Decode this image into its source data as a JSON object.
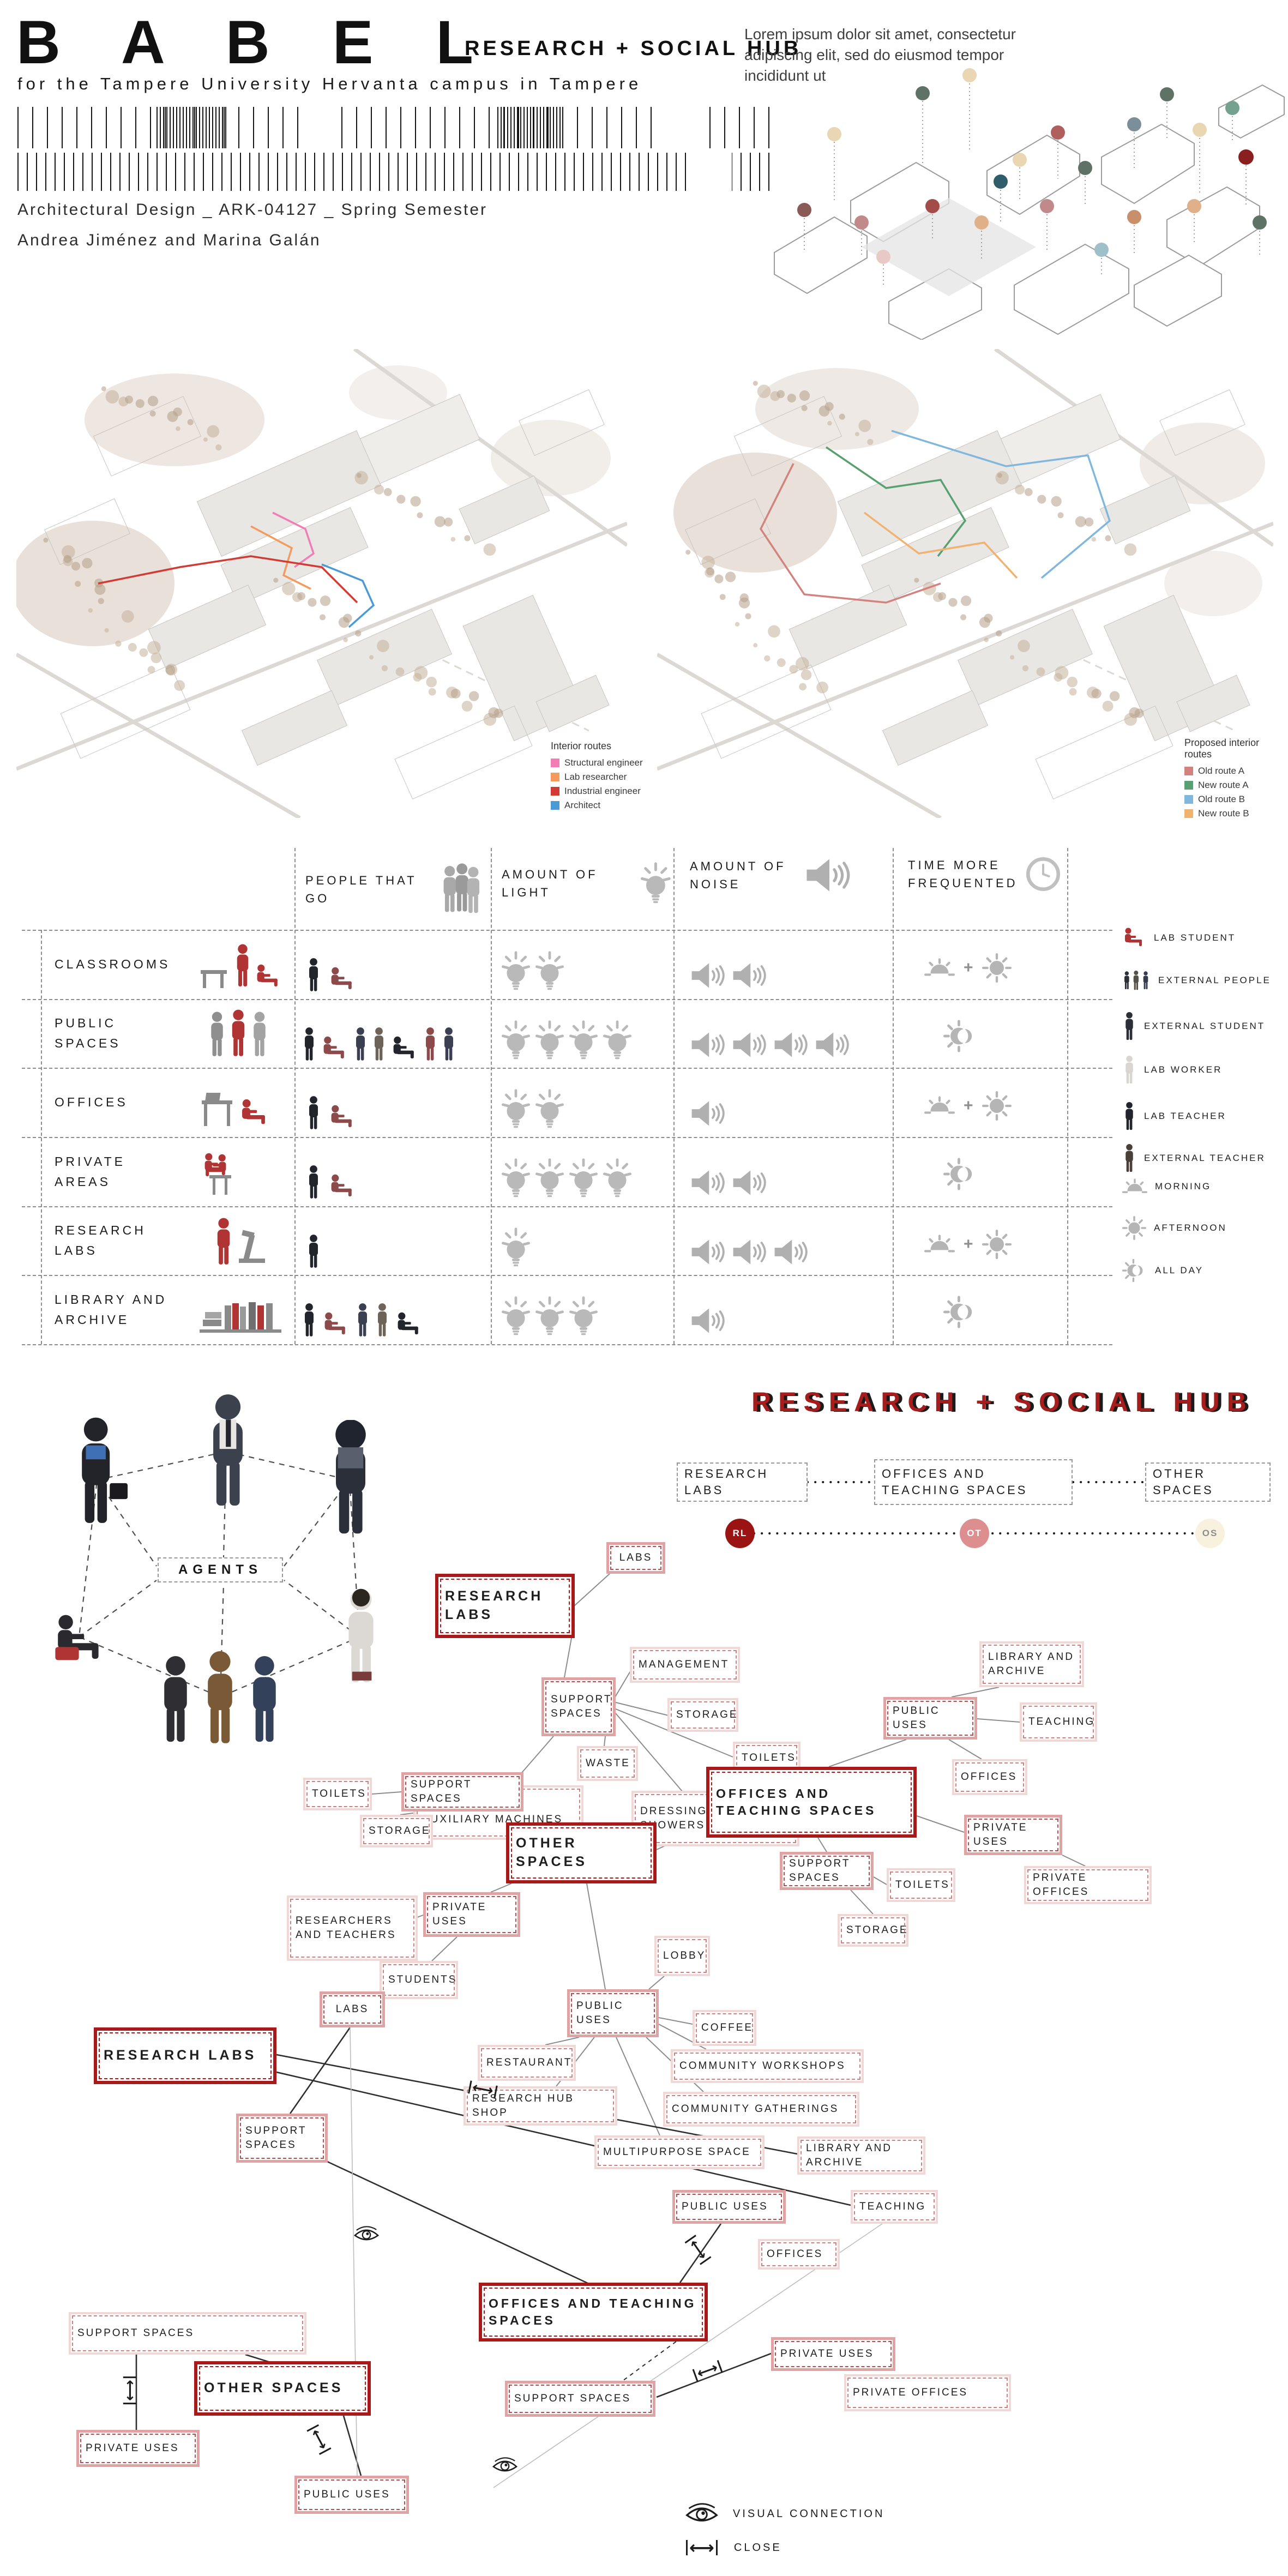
{
  "header": {
    "title": "B A B E L",
    "subtitle": "RESEARCH + SOCIAL HUB",
    "tagline": "for the Tampere University Hervanta campus in Tampere",
    "course": "Architectural Design _ ARK-04127 _ Spring Semester",
    "authors": "Andrea Jiménez and Marina Galán",
    "intro_text": "Lorem ipsum dolor sit amet, consectetur adipiscing elit, sed do eiusmod tempor incididunt ut"
  },
  "maps": {
    "existing": {
      "legend_title": "Interior routes",
      "legend": [
        {
          "label": "Structural engineer",
          "color": "#f27cb4"
        },
        {
          "label": "Lab researcher",
          "color": "#f59a5e"
        },
        {
          "label": "Industrial engineer",
          "color": "#d23b33"
        },
        {
          "label": "Architect",
          "color": "#4a9bd5"
        }
      ]
    },
    "proposed": {
      "legend_title": "Proposed interior routes",
      "legend": [
        {
          "label": "Old route A",
          "color": "#d4827e"
        },
        {
          "label": "New route A",
          "color": "#57a06f"
        },
        {
          "label": "Old route B",
          "color": "#7fb7de"
        },
        {
          "label": "New route B",
          "color": "#f2b26f"
        }
      ]
    }
  },
  "matrix": {
    "columns": [
      {
        "label": "PEOPLE THAT GO",
        "icon": "people-group-icon"
      },
      {
        "label": "AMOUNT OF LIGHT",
        "icon": "lightbulb-icon"
      },
      {
        "label": "AMOUNT OF NOISE",
        "icon": "speaker-icon"
      },
      {
        "label": "TIME MORE FREQUENTED",
        "icon": "clock-icon"
      }
    ],
    "rows": [
      {
        "label": "CLASSROOMS",
        "people": 2,
        "light": 2,
        "noise": 2,
        "time": "morning_afternoon"
      },
      {
        "label": "PUBLIC SPACES",
        "people": 7,
        "light": 4,
        "noise": 4,
        "time": "all_day"
      },
      {
        "label": "OFFICES",
        "people": 2,
        "light": 2,
        "noise": 1,
        "time": "morning_afternoon"
      },
      {
        "label": "PRIVATE AREAS",
        "people": 2,
        "light": 4,
        "noise": 2,
        "time": "all_day"
      },
      {
        "label": "RESEARCH LABS",
        "people": 1,
        "light": 1,
        "noise": 3,
        "time": "morning_afternoon"
      },
      {
        "label": "LIBRARY AND ARCHIVE",
        "people": 5,
        "light": 3,
        "noise": 1,
        "time": "all_day"
      }
    ],
    "legend": [
      {
        "label": "LAB STUDENT",
        "icon": "lab-student-icon"
      },
      {
        "label": "EXTERNAL PEOPLE",
        "icon": "external-people-icon"
      },
      {
        "label": "EXTERNAL STUDENT",
        "icon": "external-student-icon"
      },
      {
        "label": "LAB WORKER",
        "icon": "lab-worker-icon"
      },
      {
        "label": "LAB TEACHER",
        "icon": "lab-teacher-icon"
      },
      {
        "label": "EXTERNAL TEACHER",
        "icon": "external-teacher-icon"
      },
      {
        "label": "MORNING",
        "icon": "sunrise-icon"
      },
      {
        "label": "AFTERNOON",
        "icon": "sun-icon"
      },
      {
        "label": "ALL DAY",
        "icon": "all-day-icon"
      }
    ]
  },
  "agents": {
    "label": "AGENTS"
  },
  "program": {
    "title": "RESEARCH + SOCIAL HUB",
    "overview_boxes": [
      "RESEARCH LABS",
      "OFFICES AND TEACHING SPACES",
      "OTHER SPACES"
    ],
    "circles": [
      {
        "label": "RL",
        "color": "#9b1414"
      },
      {
        "label": "OT",
        "color": "#dd8f8f"
      },
      {
        "label": "OS",
        "color": "#f8f1de"
      }
    ],
    "labels": {
      "labs": "LABS",
      "research_labs": "RESEARCH LABS",
      "support_spaces": "SUPPORT SPACES",
      "management": "MANAGEMENT",
      "storage": "STORAGE",
      "toilets": "TOILETS",
      "waste": "WASTE",
      "lab_aux": "LABORATORY AUXILIARY MACHINES",
      "dressing": "DRESSING ROOMS AND SHOWERS",
      "library_archive": "LIBRARY AND ARCHIVE",
      "teaching": "TEACHING",
      "offices": "OFFICES",
      "public_uses": "PUBLIC USES",
      "private_uses": "PRIVATE USES",
      "private_offices": "PRIVATE OFFICES",
      "offices_teaching": "OFFICES AND TEACHING SPACES",
      "other_spaces": "OTHER SPACES",
      "researchers_teachers": "RESEARCHERS AND TEACHERS",
      "students": "STUDENTS",
      "lobby": "LOBBY",
      "coffee": "COFFEE",
      "restaurant": "RESTAURANT",
      "research_hub_shop": "RESEARCH HUB SHOP",
      "community_workshops": "COMMUNITY WORKSHOPS",
      "community_gatherings": "COMMUNITY GATHERINGS",
      "multipurpose": "MULTIPURPOSE SPACE"
    },
    "legend": {
      "visual": "VISUAL CONNECTION",
      "close": "CLOSE"
    }
  },
  "icons": {
    "close_arrow": "⟷",
    "plus": "+"
  },
  "colors": {
    "accent_dark_red": "#a81a1a",
    "node_pink": "#dfa3a3",
    "node_light_pink": "#f2d7d7"
  }
}
